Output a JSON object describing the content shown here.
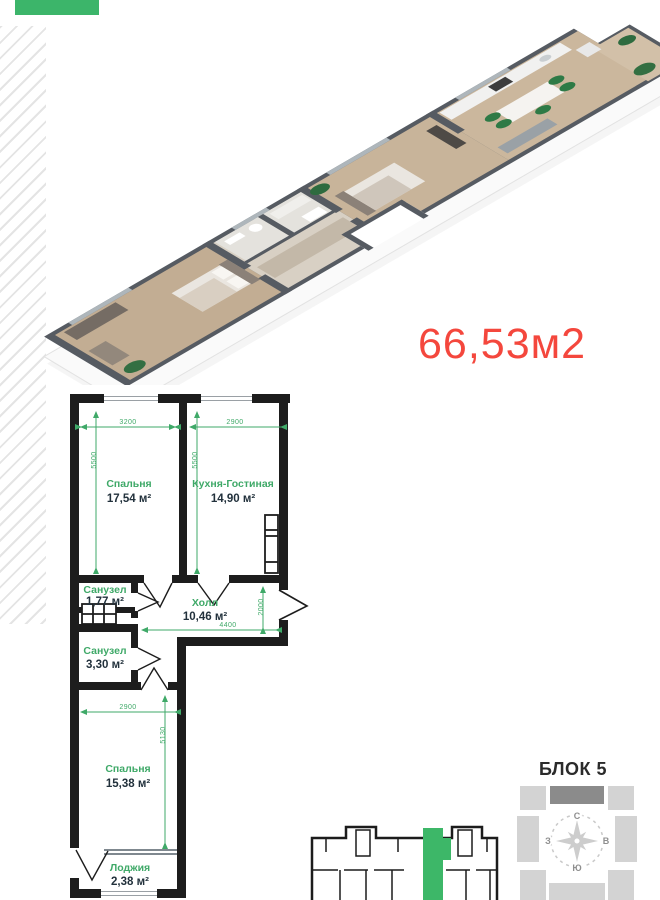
{
  "page": {
    "background": "#ffffff",
    "badge_color": "#3cb56a",
    "hatch_color": "#e4e4e4"
  },
  "area_total": {
    "text": "66,53м2",
    "color": "#f4473d"
  },
  "floor_plan": {
    "colors": {
      "wall": "#1d1d1d",
      "label": "#3fa968",
      "area_text": "#22313c",
      "dimension": "#3fa968"
    },
    "rooms": [
      {
        "name": "Спальня",
        "area": "17,54 м²"
      },
      {
        "name": "Кухня-Гостиная",
        "area": "14,90 м²"
      },
      {
        "name": "Санузел",
        "area": "1,77 м²"
      },
      {
        "name": "Холл",
        "area": "10,46 м²"
      },
      {
        "name": "Санузел",
        "area": "3,30 м²"
      },
      {
        "name": "Спальня",
        "area": "15,38 м²"
      },
      {
        "name": "Лоджия",
        "area": "2,38 м²"
      }
    ],
    "dimensions": {
      "bedroom1_width": "3200",
      "kitchen_width": "2900",
      "bedroom1_depth": "5500",
      "kitchen_depth": "5500",
      "hall_width": "4400",
      "hall_depth": "2000",
      "bedroom2_width": "2900",
      "bedroom2_depth": "5130"
    }
  },
  "block_diagram": {
    "title": "БЛОК 5",
    "compass": {
      "north": "С",
      "south": "Ю",
      "west": "З",
      "east": "В"
    },
    "highlight_color": "#8b8b8b",
    "block_color": "#d3d3d3"
  },
  "key_plan": {
    "highlight_color": "#3db768",
    "outline_color": "#1c1c1c"
  }
}
